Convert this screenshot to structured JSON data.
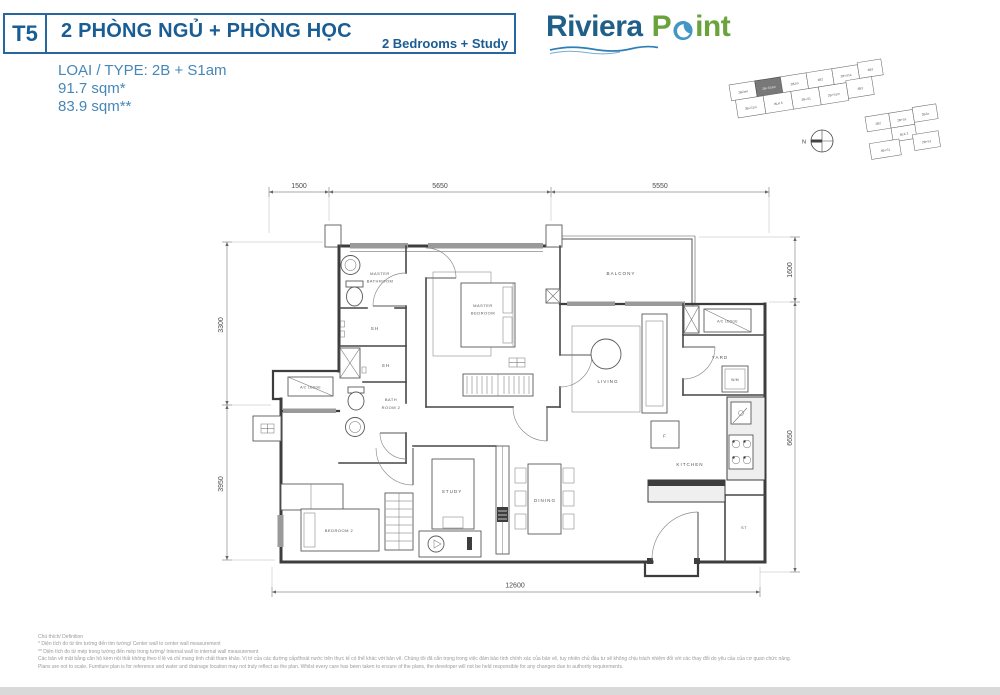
{
  "header": {
    "tower": "T5",
    "title": "2 PHÒNG NGỦ + PHÒNG HỌC",
    "subtitle": "2 Bedrooms + Study"
  },
  "unit": {
    "type": "LOẠI / TYPE: 2B + S1am",
    "area_gross": "91.7 sqm*",
    "area_net": "83.9 sqm**"
  },
  "logo": {
    "word1": "Riviera",
    "word2_initial": "P",
    "word2_rest": "int"
  },
  "keyplan": {
    "north": "N",
    "blk5_top": [
      "2B2am",
      "2B+S1am",
      "2B2m",
      "2B2",
      "2B+S1a",
      "3B3"
    ],
    "blk5_bottom": [
      "3B+S1m",
      "BLK 5",
      "3B+S1",
      "2B+S1m",
      "3B3"
    ],
    "blk3_top": [
      "2B2",
      "2B+S1",
      "2B2a"
    ],
    "blk3_mid": "BLK 3",
    "blk3_bottom": [
      "4B+S1",
      "2B+S1"
    ]
  },
  "dims": {
    "top1": "1500",
    "top2": "5650",
    "top3": "5550",
    "left1": "3300",
    "left2": "3950",
    "right1": "1600",
    "right2": "6650",
    "bottom": "12600"
  },
  "rooms": {
    "master_bathroom1": "MASTER",
    "master_bathroom2": "BATHROOM",
    "sh1": "SH",
    "sh2": "SH",
    "bathroom2a": "BATH",
    "bathroom2b": "ROOM 2",
    "master_bedroom1": "MASTER",
    "master_bedroom2": "BEDROOM",
    "balcony": "BALCONY",
    "living": "LIVING",
    "yard": "YARD",
    "wm": "W/M",
    "ac_ledge_left": "A/C LEDGE",
    "ac_ledge_right": "A/C LEDGE",
    "kitchen": "KITCHEN",
    "fridge": "F",
    "store": "ST",
    "study": "STUDY",
    "dining": "DINING",
    "bedroom2": "BEDROOM 2"
  },
  "footer": {
    "note0": "Chú thích/ Definition",
    "note1": "* Diện tích đo từ tim tường đến tim tường/ Center wall to center wall measurement",
    "note2": "** Diện tích đo từ mép trong tường đến mép trong tường/ Internal wall to internal wall measurement",
    "note3": "Các bản vẽ mặt bằng căn hộ kèm nội thất không theo tỉ lệ và chỉ mang tính chất tham khảo. Vị trí của các đường cấp/thoát nước trên thực tế có thể khác với bản vẽ. Chúng tôi đã cẩn trọng trong việc đảm bảo tính chính xác của bản vẽ, tuy nhiên chủ đầu tư sẽ không chịu trách nhiệm đối với các thay đổi do yêu cầu của cơ quan chức năng.",
    "note4": "Plans are not to scale. Furniture plan is for reference and water and drainage location may not truly reflect as the plan. Whilst every care has been taken to ensure of the plans, the developer will not be held responsible for any changes due to authority requirements."
  },
  "colors": {
    "navy": "#1a5d94",
    "steel_blue": "#4787b8",
    "logo_green": "#6aa23c",
    "logo_navy": "#205f88",
    "swirl_blue": "#4396c6"
  }
}
